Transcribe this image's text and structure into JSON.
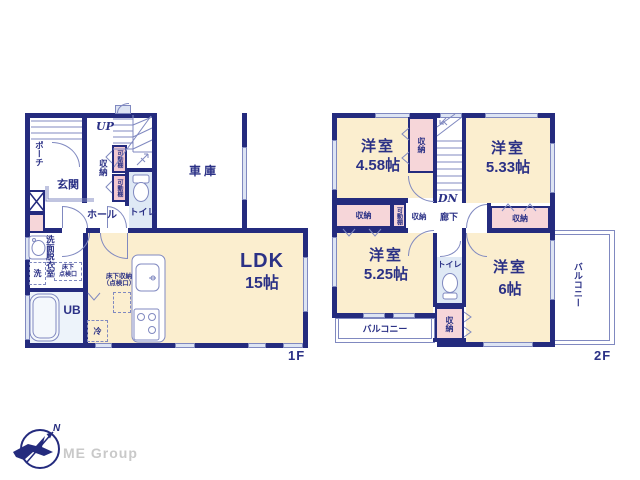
{
  "palette": {
    "wall_navy": "#242b7e",
    "text_navy": "#2b3186",
    "floor_cream": "#fbeecf",
    "floor_blue": "#dfe9f5",
    "closet_pink": "#f6d6d9",
    "fixture_line": "#8089c0",
    "logo_gray": "#c9c9c9"
  },
  "floor1": {
    "floor_label": "1F",
    "porch": "ポーチ",
    "entrance": "玄関",
    "stairs_up": "UP",
    "storage": "収納",
    "movable_shelf_upper": "可動棚",
    "movable_shelf_lower": "可動棚",
    "hall": "ホール",
    "toilet": "トイレ",
    "garage": "車庫",
    "washroom": "洗面脱衣室",
    "washer": "洗",
    "underfloor_hatch_l1": "床下",
    "underfloor_hatch_l2": "点検口",
    "unit_bath": "UB",
    "underfloor_storage_l1": "床下収納",
    "underfloor_storage_l2": "（点検口）",
    "fridge": "冷",
    "ldk_name": "LDK",
    "ldk_size": "15帖"
  },
  "floor2": {
    "floor_label": "2F",
    "room_nw_name": "洋室",
    "room_nw_size": "4.58帖",
    "room_ne_name": "洋室",
    "room_ne_size": "5.33帖",
    "room_sw_name": "洋室",
    "room_sw_size": "5.25帖",
    "room_se_name": "洋室",
    "room_se_size": "6帖",
    "stairs_down": "DN",
    "corridor": "廊下",
    "toilet": "トイレ",
    "closet_nw": "収納",
    "closet_w": "収納",
    "movable_shelf": "可動棚",
    "closet_w_small": "収納",
    "closet_e": "収納",
    "closet_s": "収納",
    "balcony_south": "バルコニー",
    "balcony_east": "バルコニー"
  },
  "logo": {
    "company": "ME Group",
    "north": "N"
  }
}
